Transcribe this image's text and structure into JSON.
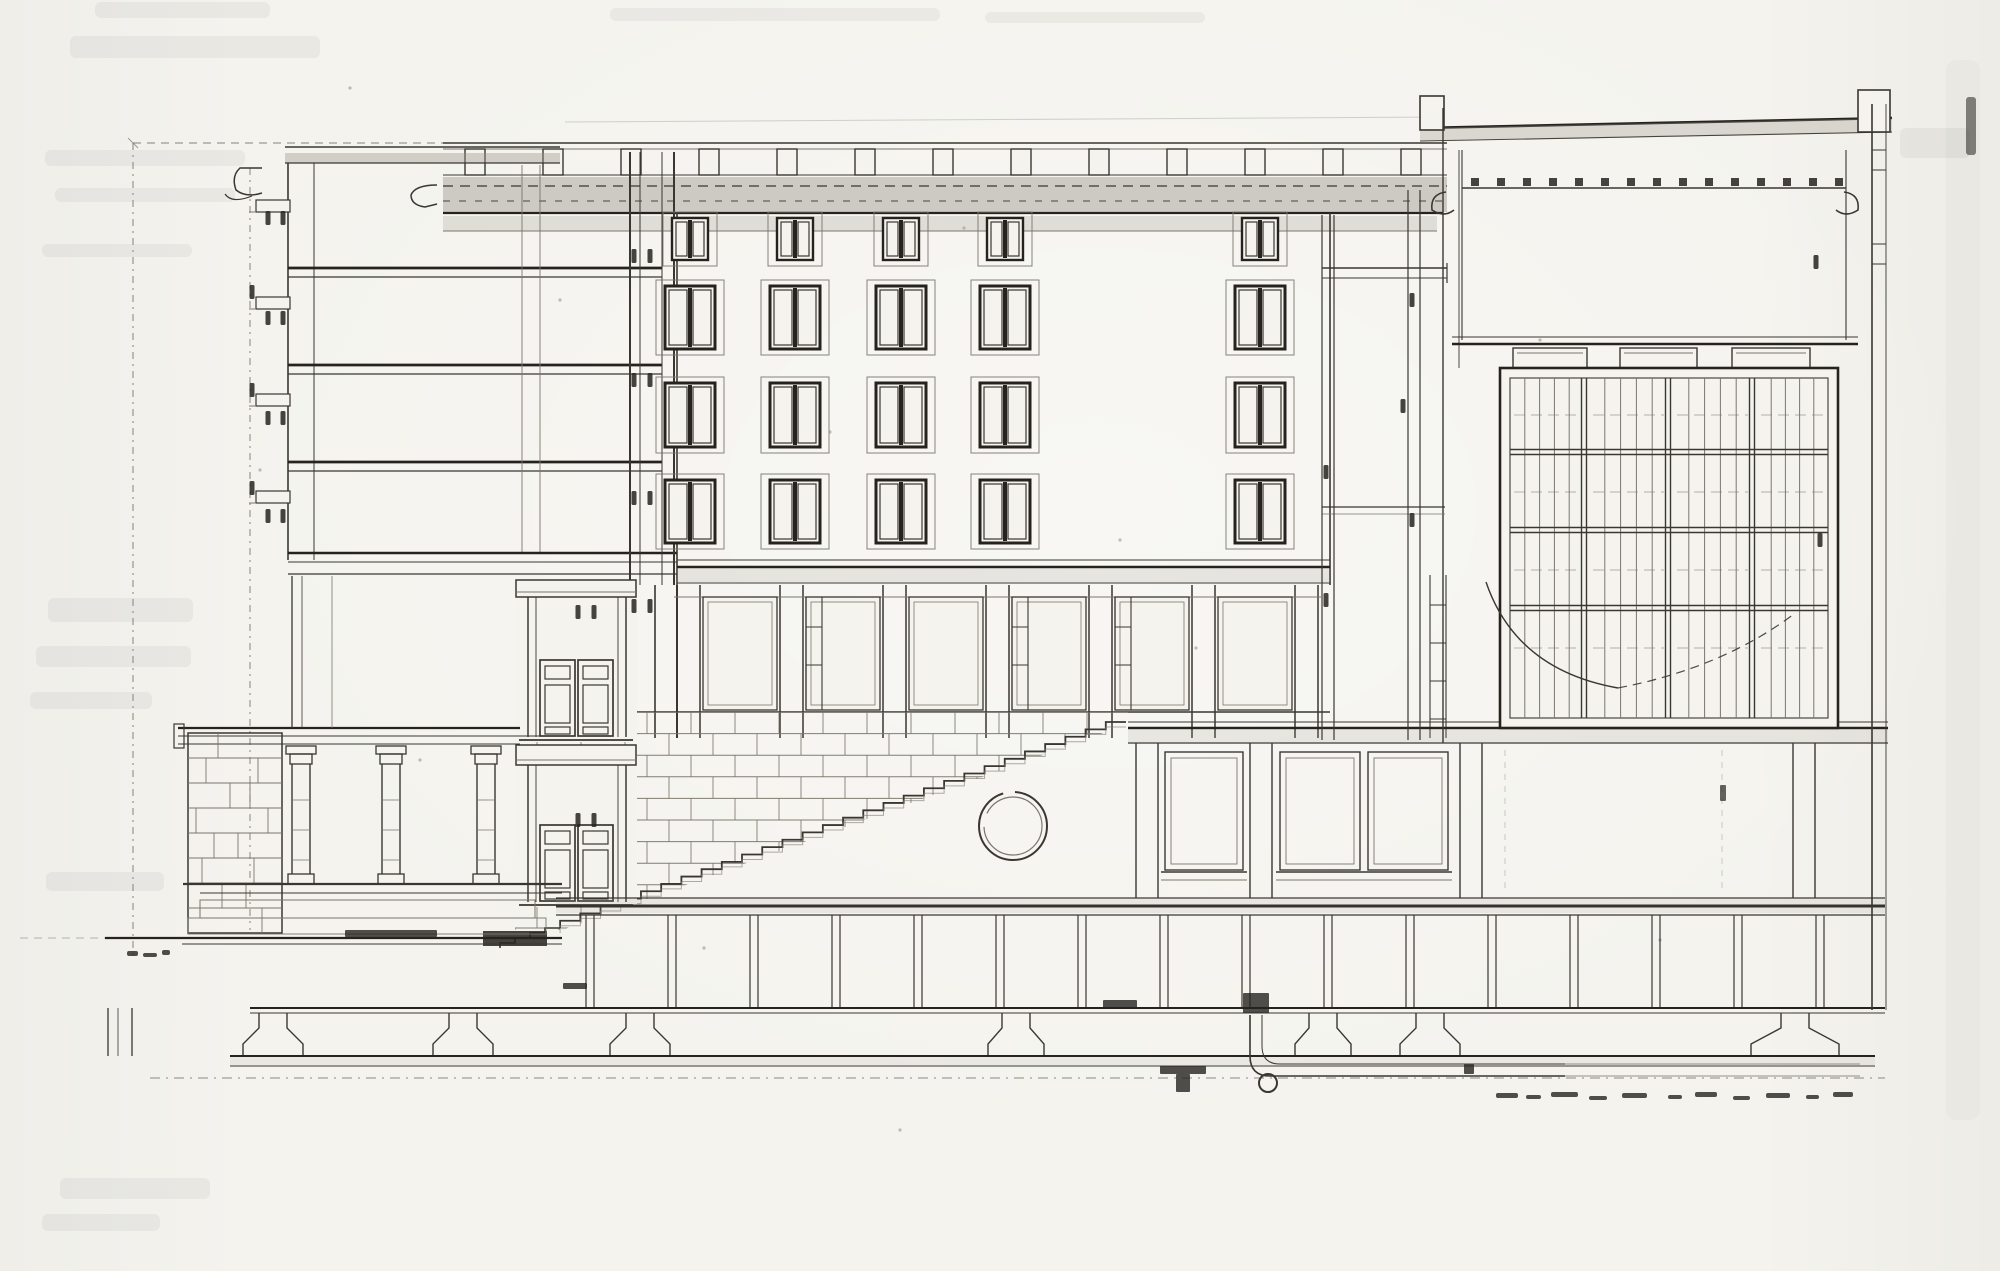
{
  "meta": {
    "label": "Scanned architectural cross-section drawing of a multi-storey building with stair, stone base and large glazed grid window"
  },
  "palette": {
    "paper": "#f4f3ee",
    "ink": "#3a3731",
    "ink_heavy": "#26231f",
    "ink_light": "#7b766c",
    "wash": "#9b968b"
  },
  "layout": {
    "width": 2000,
    "height": 1271
  },
  "reference_lines": {
    "vertical_dashdot": [
      {
        "x": 133,
        "y1": 143,
        "y2": 958
      },
      {
        "x": 250,
        "y1": 168,
        "y2": 930
      }
    ],
    "top_dashed": {
      "y": 143,
      "x1": 133,
      "x2": 443
    },
    "back_edge": {
      "y1": 122,
      "y2": 117,
      "x1": 565,
      "x2": 1445
    }
  },
  "parapet": {
    "x1": 443,
    "x2": 1447,
    "top_y": 143,
    "rail_y": 149,
    "base_y": 175,
    "posts_x": [
      465,
      543,
      621,
      699,
      777,
      855,
      933,
      1011,
      1089,
      1167,
      1245,
      1323,
      1401
    ],
    "post_w": 20,
    "post_h": 26,
    "cornice_band": {
      "y": 177,
      "h": 35
    },
    "lower_band": {
      "y": 216,
      "h": 15
    }
  },
  "left_tower": {
    "wall_x": [
      288,
      314
    ],
    "top_y": 147,
    "bottom_y": 560,
    "roof_band": {
      "y": 153,
      "h": 10,
      "x1": 285,
      "x2": 560
    },
    "floors_y": [
      268,
      365,
      462
    ],
    "floor_x1": 288,
    "floor_x2": 662,
    "interior_x": [
      522,
      540
    ],
    "sills_y": [
      200,
      297,
      394,
      491
    ],
    "bottom_band_y": [
      553,
      562,
      574
    ],
    "cut_wall_x": [
      630,
      640,
      662,
      674
    ]
  },
  "facade": {
    "x1": 677,
    "x2": 1330,
    "top_y": 213,
    "rows": [
      {
        "y": 218,
        "h": 42,
        "sash_w": 36
      },
      {
        "y": 286,
        "h": 63,
        "sash_w": 50
      },
      {
        "y": 383,
        "h": 64,
        "sash_w": 50
      },
      {
        "y": 480,
        "h": 63,
        "sash_w": 50
      }
    ],
    "cols_cx": [
      690,
      795,
      901,
      1005,
      1260
    ],
    "base_band_y": [
      560,
      567,
      583
    ]
  },
  "mid_level": {
    "top": 585,
    "bottom": 738,
    "open_top": 597,
    "open_bottom": 710,
    "piers_x": [
      677,
      780,
      883,
      986,
      1089,
      1192,
      1295
    ],
    "pier_w": 23,
    "bays": [
      [
        703,
        777
      ],
      [
        806,
        880
      ],
      [
        909,
        983
      ],
      [
        1012,
        1086
      ],
      [
        1115,
        1189
      ],
      [
        1218,
        1292
      ]
    ],
    "ladders": [
      [
        806,
        597,
        710
      ],
      [
        1012,
        597,
        710
      ],
      [
        1115,
        597,
        710
      ],
      [
        1430,
        575,
        738
      ]
    ]
  },
  "doors": {
    "upper": {
      "x": 527,
      "y": 580
    },
    "lower": {
      "x": 527,
      "y": 745
    }
  },
  "stone_wall": {
    "clip": "515,712 1128,712 1128,724 562,930 515,930",
    "x1": 515,
    "x2": 1130,
    "top": 712,
    "bottom": 930,
    "course_h": 21.6,
    "joint_step": 44
  },
  "stair": {
    "x_top": 1126,
    "y_top": 722,
    "x_bottom": 560,
    "y_bottom": 928,
    "steps": 28,
    "lower_flight": {
      "x": 560,
      "y": 928,
      "steps": 4,
      "run": 15,
      "rise": 5
    },
    "wedge": [
      483,
      931,
      64,
      15
    ]
  },
  "circle_window": {
    "cx": 1013,
    "cy": 826,
    "r_outer": 34,
    "r_inner": 29
  },
  "colonnade": {
    "rubble_pier": {
      "x": 188,
      "y": 733,
      "w": 94,
      "h": 200,
      "course_h": 25,
      "joints": [
        [
          10,
          55
        ],
        [
          30,
          70
        ],
        [
          18,
          62
        ],
        [
          42,
          80
        ],
        [
          8,
          50
        ],
        [
          26,
          66
        ],
        [
          14,
          58
        ],
        [
          34,
          74
        ]
      ]
    },
    "columns_cx": [
      301,
      391,
      486
    ],
    "terrace_y": [
      728,
      736,
      744
    ],
    "stylobate_y": [
      884,
      893
    ],
    "loggia_posts_x": [
      292,
      302,
      332
    ]
  },
  "ground": {
    "main_band": {
      "x1": 556,
      "x2": 1885,
      "lines": [
        898,
        906,
        915
      ]
    },
    "left_line": {
      "y": 938,
      "x1": 105,
      "x2": 562
    },
    "left_line2": {
      "y": 944,
      "x1": 182,
      "x2": 562
    },
    "dashed_ext": {
      "y": 938,
      "x1": 20,
      "x2": 105
    }
  },
  "basement": {
    "posts_cx": [
      590,
      672,
      754,
      836,
      918,
      1000,
      1082,
      1164,
      1246,
      1328,
      1410,
      1492,
      1574,
      1656,
      1738,
      1820
    ],
    "post_gap": 8,
    "y1": 915,
    "y2": 1008,
    "lower_lines": [
      1008,
      1013
    ],
    "footings": [
      {
        "cx": 273,
        "hw": 30
      },
      {
        "cx": 463,
        "hw": 30
      },
      {
        "cx": 640,
        "hw": 30
      },
      {
        "cx": 1016,
        "hw": 28
      },
      {
        "cx": 1323,
        "hw": 28
      },
      {
        "cx": 1430,
        "hw": 30
      },
      {
        "cx": 1795,
        "hw": 44
      }
    ],
    "base_lines": [
      1056,
      1066
    ],
    "dashdot_y": 1078,
    "left_footing_x": [
      108,
      118,
      132
    ]
  },
  "pit": {
    "outer": "M1250,1015 V1056 Q1250,1076 1270,1076 H1565",
    "inner": "M1262,1015 V1046 Q1262,1064 1280,1064 H1565",
    "drain": {
      "cx": 1268,
      "cy": 1083,
      "r": 9
    },
    "ext_lines": [
      [
        1565,
        1064,
        1860,
        1064
      ],
      [
        1565,
        1076,
        1860,
        1076
      ]
    ]
  },
  "right_hall": {
    "band_y": [
      722,
      728,
      743
    ],
    "x1": 1128,
    "x2": 1888,
    "piers": [
      [
        1136,
        1158
      ],
      [
        1250,
        1272
      ],
      [
        1460,
        1482
      ],
      [
        1793,
        1815
      ]
    ],
    "openings": [
      [
        1165,
        1243
      ],
      [
        1280,
        1360
      ],
      [
        1368,
        1448
      ]
    ],
    "open_y": 752,
    "open_h": 118,
    "sill_y": 872,
    "panel_dashes_x": [
      1505,
      1722
    ]
  },
  "right_block": {
    "roof": {
      "x1": 1420,
      "x2": 1892,
      "y1a": 128,
      "y1b": 118,
      "y2a": 141,
      "y2b": 132
    },
    "caps": [
      [
        1420,
        96,
        24,
        34
      ],
      [
        1858,
        90,
        32,
        42
      ]
    ],
    "left_wall_x": [
      1443,
      1459
    ],
    "right_wall_x": [
      1872,
      1886
    ],
    "ceiling_y": 188,
    "beam_dots": {
      "x1": 1475,
      "x2": 1840,
      "step": 26,
      "y": 178
    },
    "hall_bottom_y": [
      337,
      344
    ],
    "caps_row": [
      [
        1513,
        348,
        74,
        20
      ],
      [
        1620,
        348,
        77,
        20
      ],
      [
        1732,
        348,
        78,
        20
      ]
    ],
    "canopy": {
      "y1": 268,
      "y2": 278,
      "x1": 1322,
      "x2": 1447
    },
    "shelf": {
      "y1": 507,
      "y2": 514,
      "x1": 1322,
      "x2": 1445
    },
    "pier_pairs": [
      [
        1322,
        1334,
        215,
        740
      ],
      [
        1408,
        1420,
        190,
        740
      ]
    ],
    "wall_rungs_y": [
      150,
      170,
      244,
      264
    ]
  },
  "grid_window": {
    "x": 1500,
    "y": 368,
    "w": 338,
    "h": 360,
    "major_cols": [
      1584,
      1668,
      1752
    ],
    "major_rows": [
      452,
      530,
      608
    ],
    "bays": [
      [
        1510,
        1584
      ],
      [
        1589,
        1668
      ],
      [
        1673,
        1752
      ],
      [
        1757,
        1828
      ]
    ],
    "minor_per_bay": 4,
    "rung_rows": [
      415,
      492,
      570,
      648
    ]
  },
  "annotation_curve": {
    "solid": "M1486,582 Q1516,670 1618,688",
    "dashed": "M1618,688 Q1722,668 1794,614"
  },
  "dimension_ticks": [
    [
      268,
      218
    ],
    [
      283,
      218
    ],
    [
      268,
      318
    ],
    [
      283,
      318
    ],
    [
      268,
      418
    ],
    [
      283,
      418
    ],
    [
      268,
      516
    ],
    [
      283,
      516
    ],
    [
      252,
      292
    ],
    [
      252,
      390
    ],
    [
      252,
      488
    ],
    [
      634,
      256
    ],
    [
      650,
      256
    ],
    [
      634,
      380
    ],
    [
      650,
      380
    ],
    [
      634,
      498
    ],
    [
      650,
      498
    ],
    [
      634,
      606
    ],
    [
      650,
      606
    ],
    [
      578,
      612
    ],
    [
      594,
      612
    ],
    [
      578,
      820
    ],
    [
      594,
      820
    ],
    [
      1326,
      472
    ],
    [
      1326,
      600
    ],
    [
      1412,
      300
    ],
    [
      1412,
      520
    ],
    [
      1403,
      406
    ],
    [
      1816,
      262
    ],
    [
      1820,
      540
    ]
  ],
  "foundation_marks": [
    [
      1103,
      1000,
      34,
      8
    ],
    [
      1243,
      993,
      26,
      20
    ],
    [
      1160,
      1066,
      46,
      8
    ],
    [
      1176,
      1074,
      14,
      18
    ],
    [
      563,
      983,
      24,
      6
    ],
    [
      345,
      930,
      92,
      7
    ],
    [
      1464,
      1064,
      10,
      10
    ]
  ],
  "scribbles": [
    [
      1496,
      1093,
      22,
      5
    ],
    [
      1526,
      1095,
      15,
      4
    ],
    [
      1551,
      1092,
      27,
      5
    ],
    [
      1589,
      1096,
      18,
      4
    ],
    [
      1622,
      1093,
      25,
      5
    ],
    [
      1668,
      1095,
      14,
      4
    ],
    [
      1695,
      1092,
      22,
      5
    ],
    [
      1733,
      1096,
      17,
      4
    ],
    [
      1766,
      1093,
      24,
      5
    ],
    [
      1806,
      1095,
      13,
      4
    ],
    [
      1833,
      1092,
      20,
      5
    ],
    [
      127,
      951,
      11,
      5
    ],
    [
      143,
      953,
      14,
      4
    ],
    [
      162,
      950,
      8,
      5
    ]
  ],
  "bleed_smudges": [
    [
      95,
      2,
      175,
      16
    ],
    [
      70,
      36,
      250,
      22
    ],
    [
      45,
      150,
      200,
      16
    ],
    [
      55,
      188,
      180,
      14
    ],
    [
      42,
      244,
      150,
      13
    ],
    [
      610,
      8,
      330,
      13
    ],
    [
      985,
      12,
      220,
      11
    ],
    [
      48,
      598,
      145,
      24
    ],
    [
      36,
      646,
      155,
      21
    ],
    [
      30,
      692,
      122,
      17
    ],
    [
      46,
      872,
      118,
      19
    ],
    [
      60,
      1178,
      150,
      21
    ],
    [
      42,
      1214,
      118,
      17
    ],
    [
      1900,
      128,
      70,
      30
    ]
  ],
  "edge_mark": [
    1966,
    97,
    10,
    58
  ],
  "speckles": [
    [
      350,
      88
    ],
    [
      964,
      228
    ],
    [
      830,
      432
    ],
    [
      1196,
      648
    ],
    [
      704,
      948
    ],
    [
      1540,
      340
    ],
    [
      260,
      470
    ],
    [
      1660,
      940
    ],
    [
      900,
      1130
    ],
    [
      1240,
      298
    ],
    [
      560,
      300
    ],
    [
      1790,
      520
    ],
    [
      420,
      760
    ],
    [
      1120,
      540
    ]
  ]
}
